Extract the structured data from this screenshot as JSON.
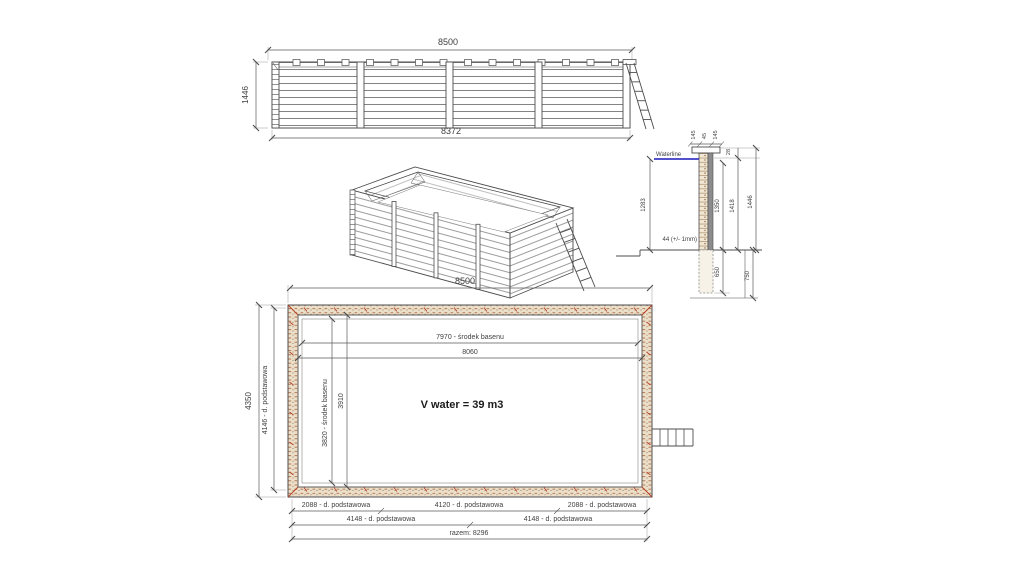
{
  "elevation": {
    "dim_width_top": "8500",
    "dim_height_left": "1446",
    "dim_width_bottom": "8372"
  },
  "section": {
    "waterline_label": "Waterline",
    "dim_water_depth": "1283",
    "dim_bottom_plank": "44 (+/- 1mm)",
    "dim_cap_left": "145",
    "dim_cap_mid": "45",
    "dim_cap_right": "145",
    "dim_cap_height": "28",
    "dim_wall_1350": "1350",
    "dim_wall_1418": "1418",
    "dim_wall_1446": "1446",
    "dim_post_below": "650",
    "dim_pit_depth": "750"
  },
  "plan": {
    "dim_width_top": "8500",
    "dim_height_total": "4350",
    "dim_height_base": "4146 - d. podstawowa",
    "dim_center_vertical": "3820 - środek basenu",
    "dim_inner_height": "3910",
    "dim_center_horizontal": "7970 - środek basenu",
    "dim_inner_width": "8060",
    "volume_label": "V water = 39 m3",
    "dim_base_row1": [
      "2088 - d. podstawowa",
      "4120 - d. podstawowa",
      "2088 - d. podstawowa"
    ],
    "dim_base_row2": [
      "4148 - d. podstawowa",
      "4148 - d. podstawowa"
    ],
    "dim_total_bottom": "razem: 8296"
  },
  "colors": {
    "line": "#4d4d4d",
    "waterline_blue": "#3a3ac8",
    "wall_fill": "#ecdfca",
    "wall_mark": "#ad6d45",
    "accent_red": "#b43a20"
  }
}
